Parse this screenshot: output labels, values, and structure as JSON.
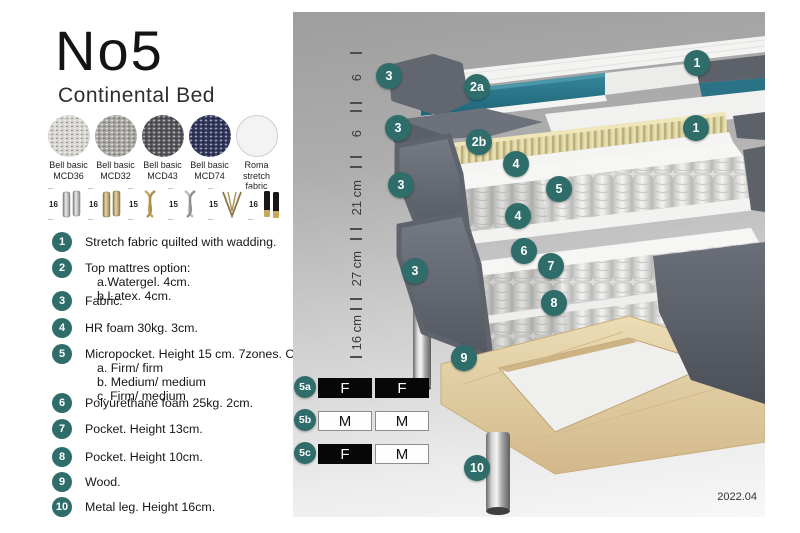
{
  "header": {
    "title": "No5",
    "subtitle": "Continental Bed"
  },
  "fabrics": [
    {
      "name": "Bell basic",
      "code": "MCD36",
      "color": "#d6d4cf"
    },
    {
      "name": "Bell basic",
      "code": "MCD32",
      "color": "#a7a5a0"
    },
    {
      "name": "Bell basic",
      "code": "MCD43",
      "color": "#54555a"
    },
    {
      "name": "Bell basic",
      "code": "MCD74",
      "color": "#30355c"
    },
    {
      "name": "Roma",
      "code": "stretch fabric",
      "color": "#f3f3f3"
    }
  ],
  "leg_options": [
    {
      "height": "16",
      "type": "cylinder-silver"
    },
    {
      "height": "16",
      "type": "cylinder-gold"
    },
    {
      "height": "15",
      "type": "twist-gold"
    },
    {
      "height": "15",
      "type": "twist-silver"
    },
    {
      "height": "15",
      "type": "hairpin-gold"
    },
    {
      "height": "16",
      "type": "black-gold"
    }
  ],
  "list": [
    {
      "num": "1",
      "text": "Stretch fabric quilted with wadding."
    },
    {
      "num": "2",
      "text": "Top mattres option:",
      "sub": [
        "a.Watergel. 4cm.",
        "b.Latex. 4cm."
      ]
    },
    {
      "num": "3",
      "text": "Fabric."
    },
    {
      "num": "4",
      "text": "HR foam 30kg. 3cm."
    },
    {
      "num": "5",
      "text": "Micropocket. Height 15 cm. 7zones. Option:",
      "sub": [
        "a. Firm/ firm",
        "b. Medium/ medium",
        "c. Firm/ medium"
      ]
    },
    {
      "num": "6",
      "text": "Polyurethane foam 25kg. 2cm."
    },
    {
      "num": "7",
      "text": "Pocket. Height 13cm."
    },
    {
      "num": "8",
      "text": "Pocket. Height 10cm."
    },
    {
      "num": "9",
      "text": "Wood."
    },
    {
      "num": "10",
      "text": "Metal leg. Height 16cm."
    }
  ],
  "ruler": [
    "6",
    "6",
    "21 cm",
    "27 cm",
    "16 cm"
  ],
  "callouts": [
    "3",
    "2a",
    "1",
    "3",
    "2b",
    "1",
    "4",
    "5",
    "3",
    "4",
    "6",
    "3",
    "7",
    "8",
    "9",
    "10"
  ],
  "firmness": [
    {
      "id": "5a",
      "cells": [
        {
          "t": "F"
        },
        {
          "t": "F"
        }
      ]
    },
    {
      "id": "5b",
      "cells": [
        {
          "t": "M"
        },
        {
          "t": "M"
        }
      ]
    },
    {
      "id": "5c",
      "cells": [
        {
          "t": "F"
        },
        {
          "t": "M"
        }
      ]
    }
  ],
  "version": "2022.04",
  "colors": {
    "accent_teal": "#2f6d6b",
    "watergel_teal": "#2b7c90",
    "latex_tan": "#ddd5a6",
    "cover_gray": "#5c6069",
    "wood": "#e3d0a3",
    "panel_gray_top": "#9e9e9e",
    "panel_gray_bottom": "#f8f8f8"
  }
}
